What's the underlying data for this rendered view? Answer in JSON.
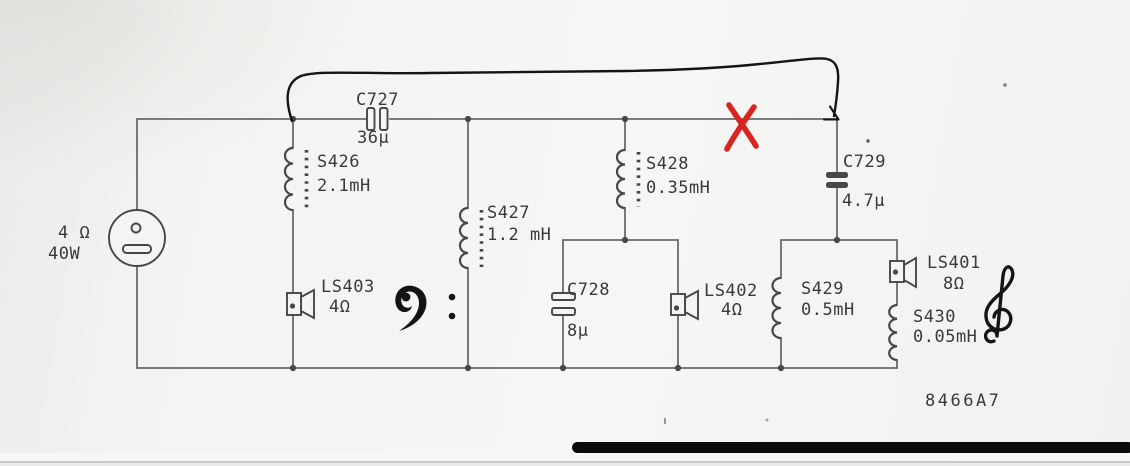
{
  "figure": {
    "type": "loudspeaker crossover schematic (scanned, annotated)",
    "drawing_number": "8466A7"
  },
  "source": {
    "impedance": "4 Ω",
    "power": "40W"
  },
  "components": {
    "c727": {
      "name": "C727",
      "value": "36µ"
    },
    "s426": {
      "name": "S426",
      "value": "2.1mH"
    },
    "s427": {
      "name": "S427",
      "value": "1.2 mH"
    },
    "s428": {
      "name": "S428",
      "value": "0.35mH"
    },
    "c728": {
      "name": "C728",
      "value": "8µ"
    },
    "ls403": {
      "name": "LS403",
      "value": "4Ω"
    },
    "ls402": {
      "name": "LS402",
      "value": "4Ω"
    },
    "c729": {
      "name": "C729",
      "value": "4.7µ"
    },
    "s429": {
      "name": "S429",
      "value": "0.5mH"
    },
    "s430": {
      "name": "S430",
      "value": "0.05mH"
    },
    "ls401": {
      "name": "LS401",
      "value": "8Ω"
    }
  },
  "annotations": {
    "hand_drawn_arrow": "curved ink line from S426 top node to C729 branch point, arrowhead at end",
    "red_x": "red X mark on top bus left of C729 branch",
    "bass_clef": "bass clef symbol near LS403 (woofer section)",
    "treble_clef": "treble clef symbol near LS401 (tweeter section)",
    "red_x_color": "#d9251f",
    "ink_color": "#141414",
    "wire_color": "#6a6a6a",
    "component_color": "#474747",
    "text_color": "#3a3a3a",
    "paper_color": "#f4f4f2",
    "bar_color": "#0b0b0b"
  }
}
